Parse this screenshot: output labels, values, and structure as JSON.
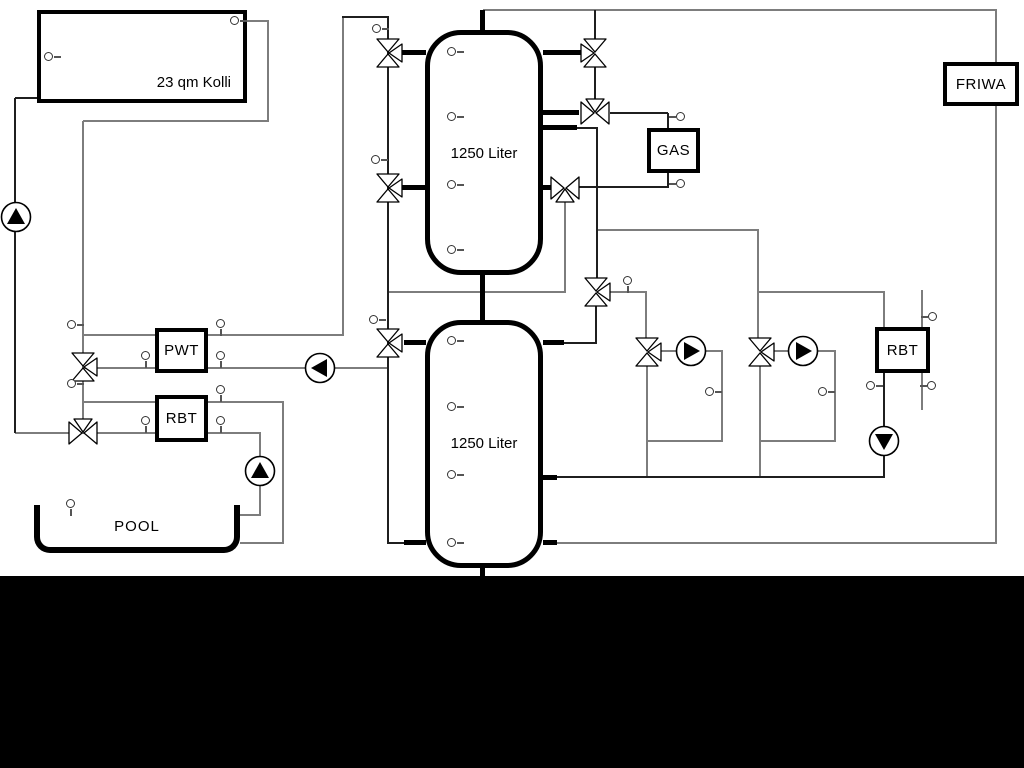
{
  "diagram": {
    "type": "hydraulic-schematic",
    "components": {
      "collector": {
        "label": "23 qm Kolli"
      },
      "tank_top": {
        "label": "1250 Liter"
      },
      "tank_bottom": {
        "label": "1250 Liter"
      },
      "gas_boiler": {
        "label": "GAS"
      },
      "friwa": {
        "label": "FRIWA"
      },
      "pwt": {
        "label": "PWT"
      },
      "rbt_left": {
        "label": "RBT"
      },
      "rbt_right": {
        "label": "RBT"
      },
      "pool": {
        "label": "POOL"
      }
    },
    "colors": {
      "background": "#ffffff",
      "pipe_gray": "#7d7d7d",
      "pipe_dark": "#1f1f1f",
      "symbol_stroke": "#000000",
      "bottom_band": "#000000"
    }
  }
}
